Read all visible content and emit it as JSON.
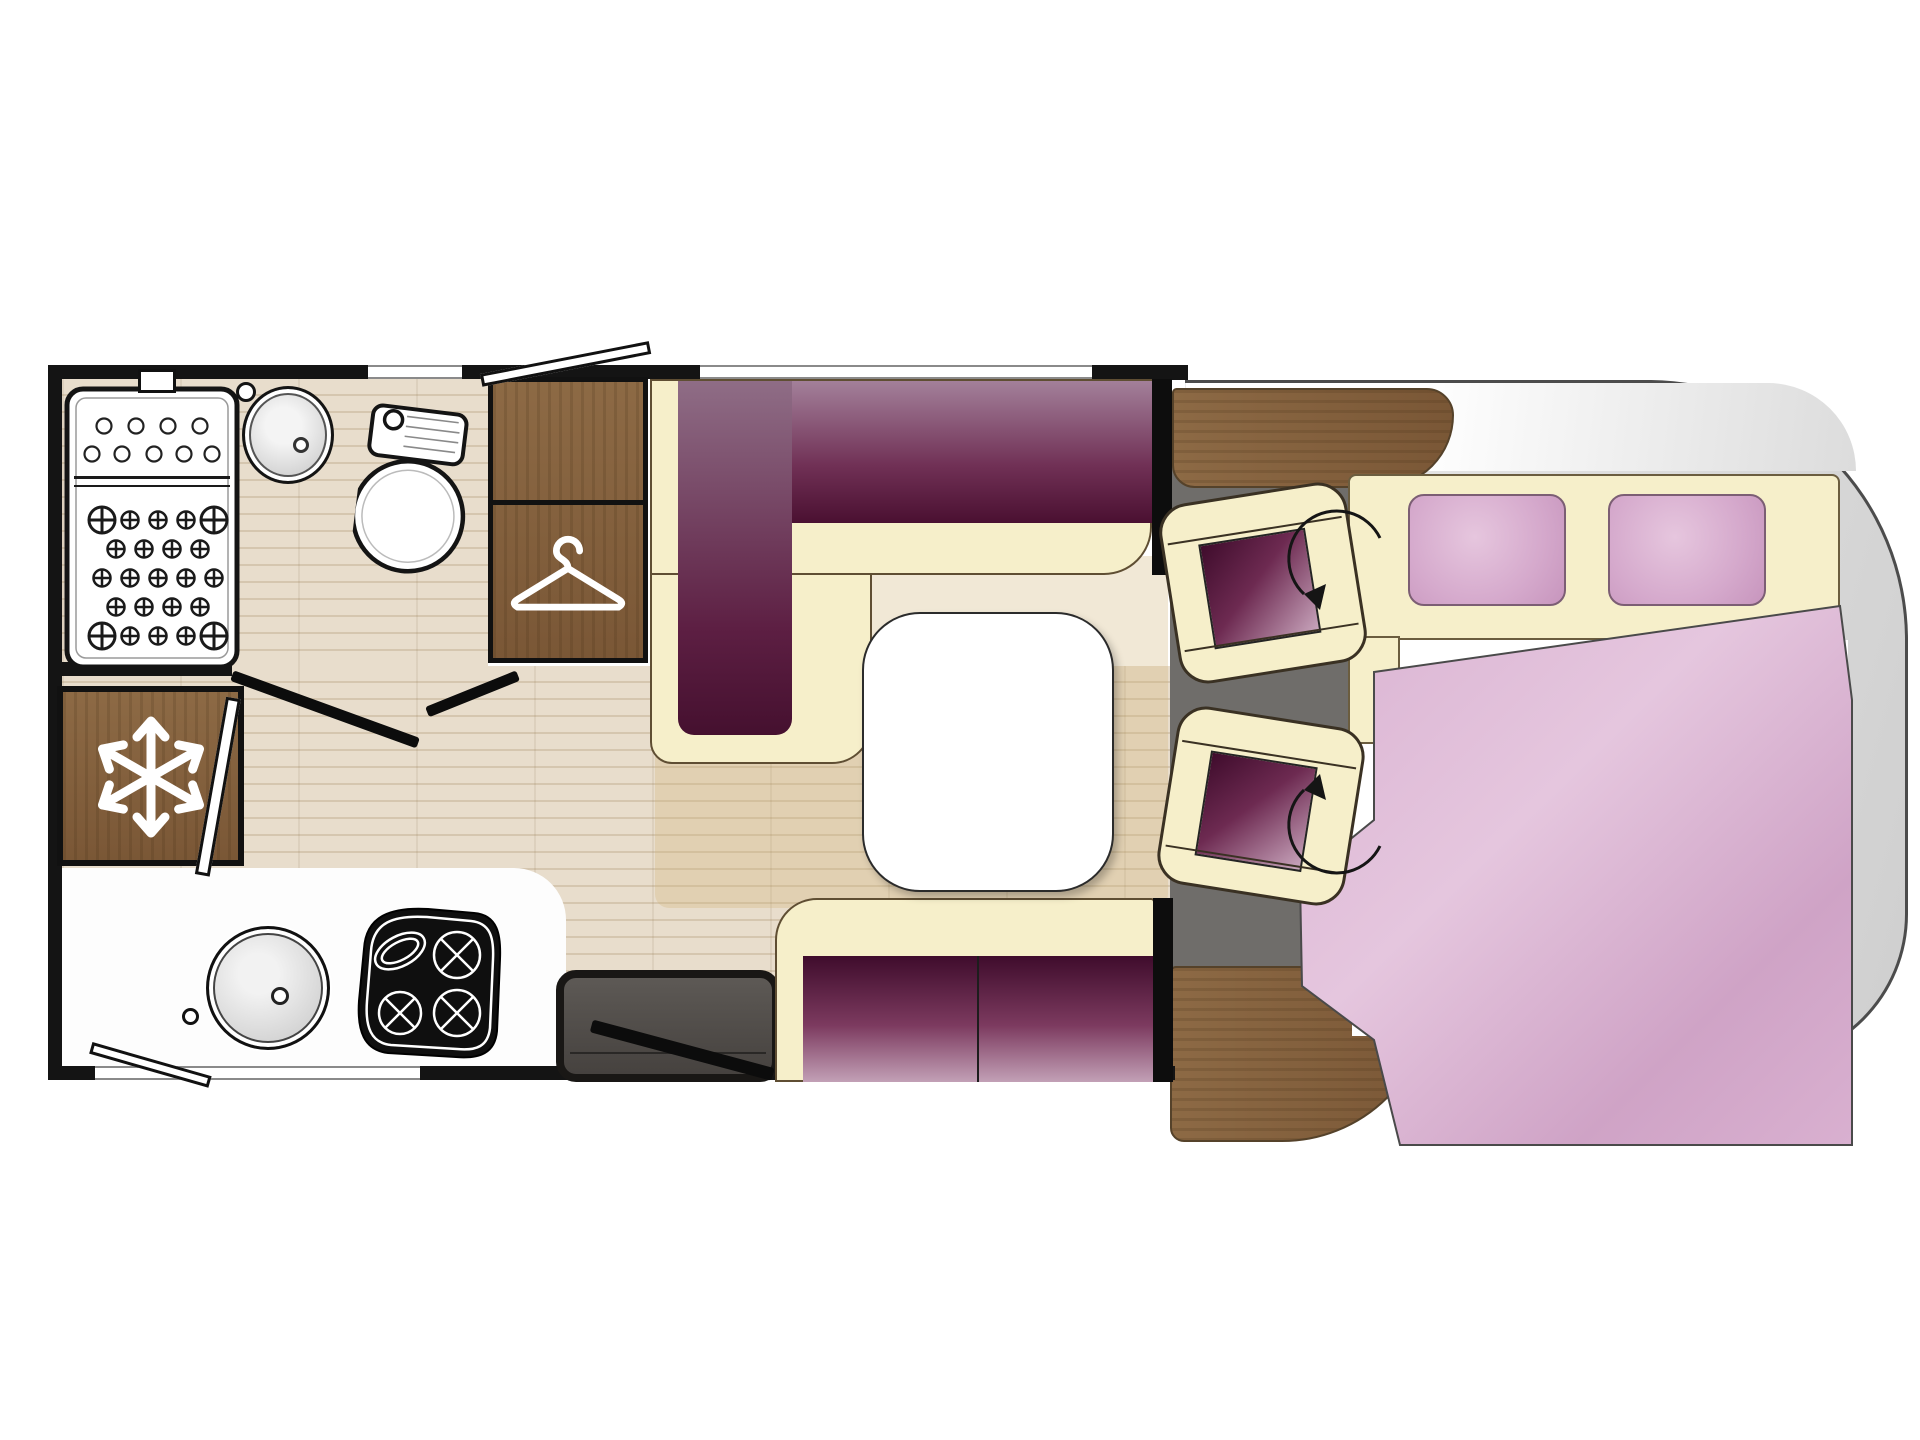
{
  "document": {
    "type": "motorhome-floor-plan",
    "view": "top-down layout drawing, rear wall at left, curved cab front at right",
    "visible_text": "none"
  },
  "palette": {
    "wall": "#141414",
    "cream": "#f6efca",
    "cream_line": "#5f4e33",
    "purple_dark": "#46102f",
    "purple_mid": "#8f6d86",
    "purple_light": "#c5a2b9",
    "wood": "#8d6a45",
    "wood_dark": "#7a5736",
    "floor": "#e8ddcc",
    "floor_line": "#d5c6af",
    "cab_gray": "#6f6d6a",
    "body_gray": "#dadada",
    "body_line": "#4c4c4c",
    "pink": "#d7aecf",
    "step": "#56524e"
  },
  "zones": {
    "bathroom": {
      "position": "rear left",
      "fixtures": [
        "shower-tray",
        "washbasin",
        "toilet"
      ],
      "window_count": 1
    },
    "wardrobe": {
      "icon": "hanger-icon",
      "sections": 2
    },
    "refrigerator": {
      "icon": "snowflake-icon"
    },
    "kitchen": {
      "fixtures": [
        "round-sink",
        "hob-3-burner-with-oval-dish"
      ],
      "window_count": 1
    },
    "entrance": {
      "features": [
        "entry-step",
        "open-entry-door-swing"
      ]
    },
    "dinette": {
      "seating": [
        "L-shaped-bench-sofa",
        "two-seat-bench-sofa"
      ],
      "table": "white rounded-square pedestal table",
      "window_count": 1
    },
    "cab": {
      "swivel_seats": 2,
      "features": [
        "wood-dashboard",
        "rotation-arrows",
        "gray-cab-floor",
        "windshield-band"
      ]
    },
    "bedroom": {
      "bed": "double bed in curved front section",
      "pillows": 2,
      "bedding": "pink duvet draped diagonally"
    }
  },
  "annotations": {
    "door_swings": 3,
    "open_window_flaps": 2,
    "open_door_leaves": 1
  }
}
